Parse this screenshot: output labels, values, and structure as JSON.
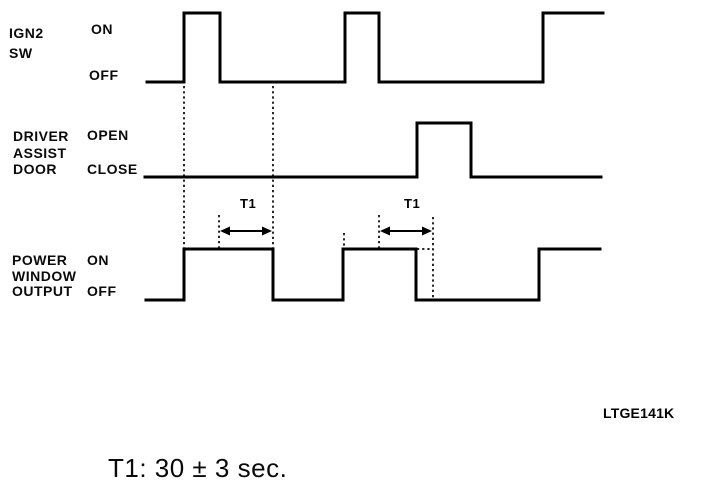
{
  "page": {
    "background": "#ffffff",
    "ink": "#000000"
  },
  "signals": [
    {
      "id": "ign2-sw",
      "label_lines": [
        "IGN2",
        "SW"
      ],
      "high_label": "ON",
      "low_label": "OFF",
      "high_y": 13,
      "low_y": 82,
      "points": [
        [
          147,
          82
        ],
        [
          184,
          82
        ],
        [
          184,
          13
        ],
        [
          220,
          13
        ],
        [
          220,
          82
        ],
        [
          345,
          82
        ],
        [
          345,
          13
        ],
        [
          379,
          13
        ],
        [
          379,
          82
        ],
        [
          543,
          82
        ],
        [
          543,
          13
        ],
        [
          603,
          13
        ]
      ]
    },
    {
      "id": "driver-assist-door",
      "label_lines": [
        "DRIVER",
        "ASSIST",
        "DOOR"
      ],
      "high_label": "OPEN",
      "low_label": "CLOSE",
      "high_y": 123,
      "low_y": 177,
      "points": [
        [
          145,
          177
        ],
        [
          417,
          177
        ],
        [
          417,
          123
        ],
        [
          471,
          123
        ],
        [
          471,
          177
        ],
        [
          601,
          177
        ]
      ]
    },
    {
      "id": "power-window-output",
      "label_lines": [
        "POWER",
        "WINDOW",
        "OUTPUT"
      ],
      "high_label": "ON",
      "low_label": "OFF",
      "high_y": 249,
      "low_y": 300,
      "points": [
        [
          146,
          300
        ],
        [
          184,
          300
        ],
        [
          184,
          249
        ],
        [
          273,
          249
        ],
        [
          273,
          300
        ],
        [
          343,
          300
        ],
        [
          343,
          249
        ],
        [
          416,
          249
        ],
        [
          416,
          300
        ],
        [
          539,
          300
        ],
        [
          539,
          249
        ],
        [
          600,
          249
        ]
      ]
    }
  ],
  "guides": [
    {
      "id": "guide-ign2-rise1",
      "x1": 184,
      "y1": 86,
      "x2": 184,
      "y2": 248
    },
    {
      "id": "guide-t1a-left",
      "x1": 219,
      "y1": 215,
      "x2": 219,
      "y2": 248
    },
    {
      "id": "guide-t1a-right",
      "x1": 273,
      "y1": 86,
      "x2": 273,
      "y2": 248
    },
    {
      "id": "guide-ign2-rise2",
      "x1": 344,
      "y1": 233,
      "x2": 344,
      "y2": 247
    },
    {
      "id": "guide-t1b-left",
      "x1": 379,
      "y1": 215,
      "x2": 379,
      "y2": 248
    },
    {
      "id": "guide-t1b-right",
      "x1": 433,
      "y1": 217,
      "x2": 433,
      "y2": 300
    },
    {
      "id": "guide-output-extension",
      "x1": 417,
      "y1": 249,
      "x2": 433,
      "y2": 249
    }
  ],
  "intervals": [
    {
      "label": "T1",
      "x1": 220,
      "x2": 272,
      "y": 231,
      "label_left": 240,
      "label_top": 197
    },
    {
      "label": "T1",
      "x1": 380,
      "x2": 432,
      "y": 231,
      "label_left": 404,
      "label_top": 197
    }
  ],
  "code_label": "LTGE141K",
  "caption": "T1: 30 ± 3 sec."
}
